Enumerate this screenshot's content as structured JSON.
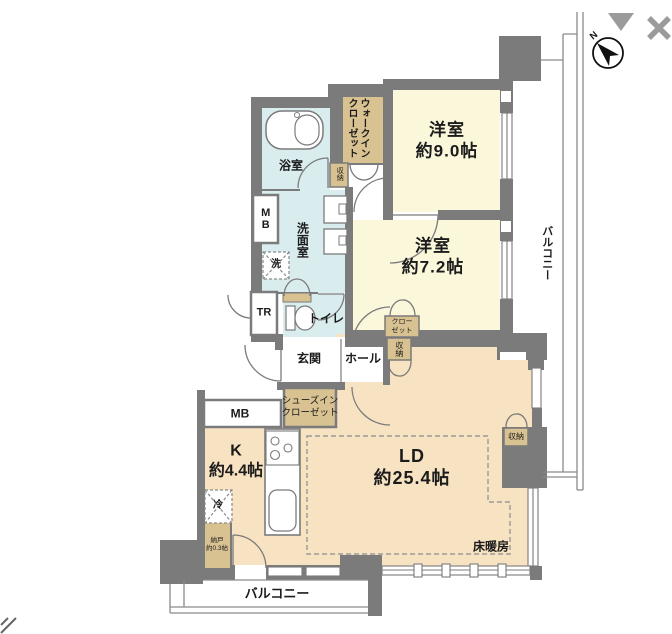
{
  "colors": {
    "wall": "#7b7b7b",
    "tatami_room_fill": "#FAF7DB",
    "living_fill": "#F7E2C2",
    "wet_area_fill": "#D9ECEE",
    "closet_fill": "#D9C291",
    "ui_icon_gray": "#9b9b9b"
  },
  "rooms": {
    "bedroom1": {
      "name": "洋室",
      "area": "約9.0帖"
    },
    "bedroom2": {
      "name": "洋室",
      "area": "約7.2帖"
    },
    "living_dining": {
      "name": "LD",
      "area": "約25.4帖"
    },
    "kitchen": {
      "name": "K",
      "area": "約4.4帖"
    },
    "bathroom": {
      "name": "浴室"
    },
    "washroom": {
      "name": "洗面室"
    },
    "toilet": {
      "name": "トイレ"
    },
    "entrance": {
      "name": "玄関"
    },
    "hall": {
      "name": "ホール"
    },
    "nando": {
      "name": "納戸",
      "area": "約0.3帖"
    }
  },
  "storage": {
    "walk_in_closet": {
      "line1": "ウォークイン",
      "line2": "クローゼット"
    },
    "shoes_in_closet": {
      "line1": "シューズイン",
      "line2": "クローゼット"
    },
    "closet": {
      "line1": "クロー",
      "line2": "ゼット"
    },
    "storage_wic": "収納",
    "storage_ld_top": "収納",
    "storage_ld_right": "収納",
    "trunk_room": "TR"
  },
  "utilities": {
    "meter_box_upper": "MB",
    "meter_box_lower": "MB",
    "laundry": "洗",
    "refrigerator": "冷",
    "floor_heating": "床暖房"
  },
  "outdoor": {
    "balcony_right": "バルコニー",
    "balcony_bottom": "バルコニー"
  },
  "compass": {
    "north": "N"
  }
}
